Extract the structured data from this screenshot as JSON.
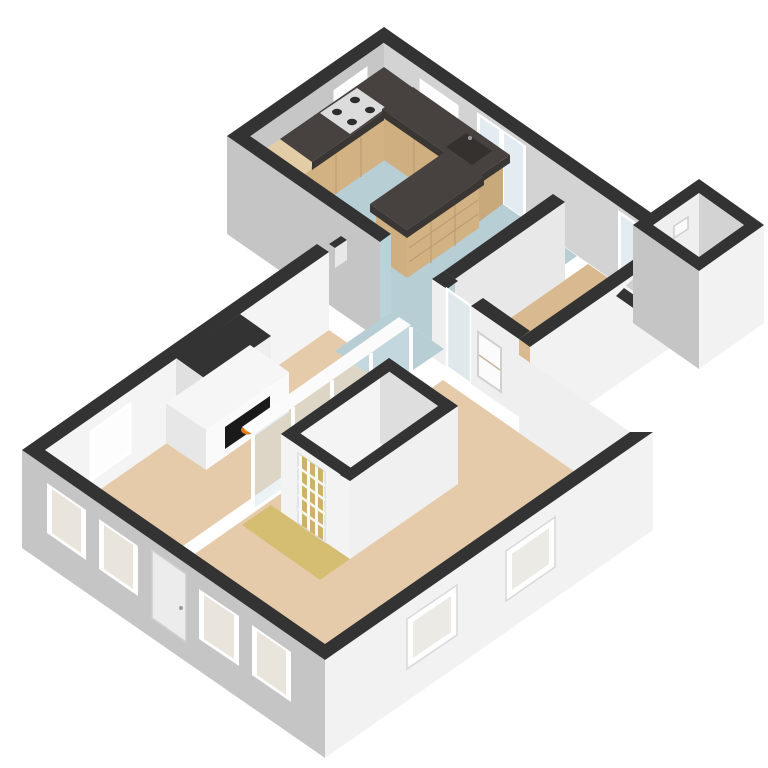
{
  "scene": {
    "type": "3d-floorplan",
    "view": "isometric-birdseye",
    "background": "#ffffff"
  },
  "colors": {
    "wallTop": "#333333",
    "wallTopSoft": "#3a3a3a",
    "extGray": "#c5c5c5",
    "extGrayDark": "#b2b2b2",
    "extWhite": "#f2f2f2",
    "innerBright": "#f4f4f4",
    "innerWhite": "#efefef",
    "innerShaded": "#c6c6c6",
    "innerMid": "#d3d3d3",
    "innerSoft": "#e8e8e8",
    "kitchenFloor": "#b7ced5",
    "livingFloor": "#e6cbaa",
    "hallFloor": "#d9b98f",
    "goldFloor": "#d5bd72",
    "stairStripFloor": "#bdd2da",
    "porchFloor": "#c9cbcc",
    "corridorFloor": "#cfcfcf",
    "wood": "#d2b183",
    "woodShade": "#c8a97c",
    "woodFace": "#cfae80",
    "woodTop": "#e3cda6",
    "counterTop": "#474240",
    "counterEdge": "#3a3634",
    "stoveTop": "#dcdcdc",
    "burner": "#2d2d2d",
    "sink": "#35312f",
    "glass": "#e3edf1",
    "glassTint": "#dfe9ec",
    "frameWhite": "#ffffff",
    "windowGlow": "#fdfdfd",
    "windowInset": "#e9e5dd",
    "frameGray": "#cfcfcf",
    "blueWall": "#b9d3da",
    "firebox": "#1a1a1a",
    "flame": "#e07a1f",
    "flameCore": "#f2a33c",
    "doorPane": "#cdb36a",
    "doorPanel": "#ececec",
    "treadLine": "#c9c9c9",
    "stepLine": "#9fb7c0"
  },
  "rooms": [
    {
      "id": "kitchen",
      "floor": "#b7ced5"
    },
    {
      "id": "dining-nook",
      "floor": "#b7ced5"
    },
    {
      "id": "hallway",
      "floor": "#d9b98f"
    },
    {
      "id": "basement-stairs",
      "floor": "#bdd2da"
    },
    {
      "id": "porch",
      "floor": "#c9cbcc"
    },
    {
      "id": "sitting-room",
      "floor": "#e6cbaa"
    },
    {
      "id": "living-room",
      "floor": "#e6cbaa"
    },
    {
      "id": "stair-hall",
      "floor": "#d5bd72"
    }
  ],
  "features": [
    "l-shaped-kitchen-counter",
    "kitchen-island",
    "stove-4-burners",
    "sink",
    "tall-cabinet",
    "fireplace-with-flame",
    "winder-staircase",
    "glazed-panel-door",
    "french-doors",
    "glass-partition",
    "front-door",
    "windows"
  ]
}
